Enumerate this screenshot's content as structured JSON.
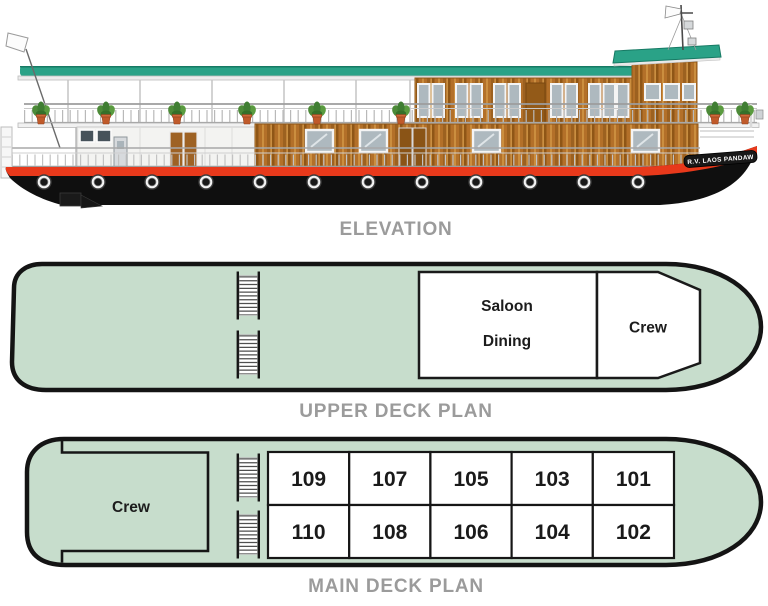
{
  "labels": {
    "elevation": "ELEVATION",
    "upper_deck": "UPPER DECK PLAN",
    "main_deck": "MAIN DECK PLAN"
  },
  "ship": {
    "name": "R.V. LAOS PANDAW"
  },
  "upper_deck": {
    "rooms": {
      "saloon": "Saloon",
      "dining": "Dining",
      "crew": "Crew"
    }
  },
  "main_deck": {
    "crew": "Crew",
    "cabins_top": [
      "109",
      "107",
      "105",
      "103",
      "101"
    ],
    "cabins_bottom": [
      "110",
      "108",
      "106",
      "104",
      "102"
    ]
  },
  "colors": {
    "deck_fill": "#c7ddcc",
    "deck_outline": "#141414",
    "roof_teal": "#2aa287",
    "roof_teal_edge": "#177a64",
    "hull_black": "#0f0f0f",
    "stripe_red": "#e8391b",
    "wood_brown": "#b37029",
    "window_glass": "#aeb9bf",
    "label_gray": "#9b9b9b"
  }
}
